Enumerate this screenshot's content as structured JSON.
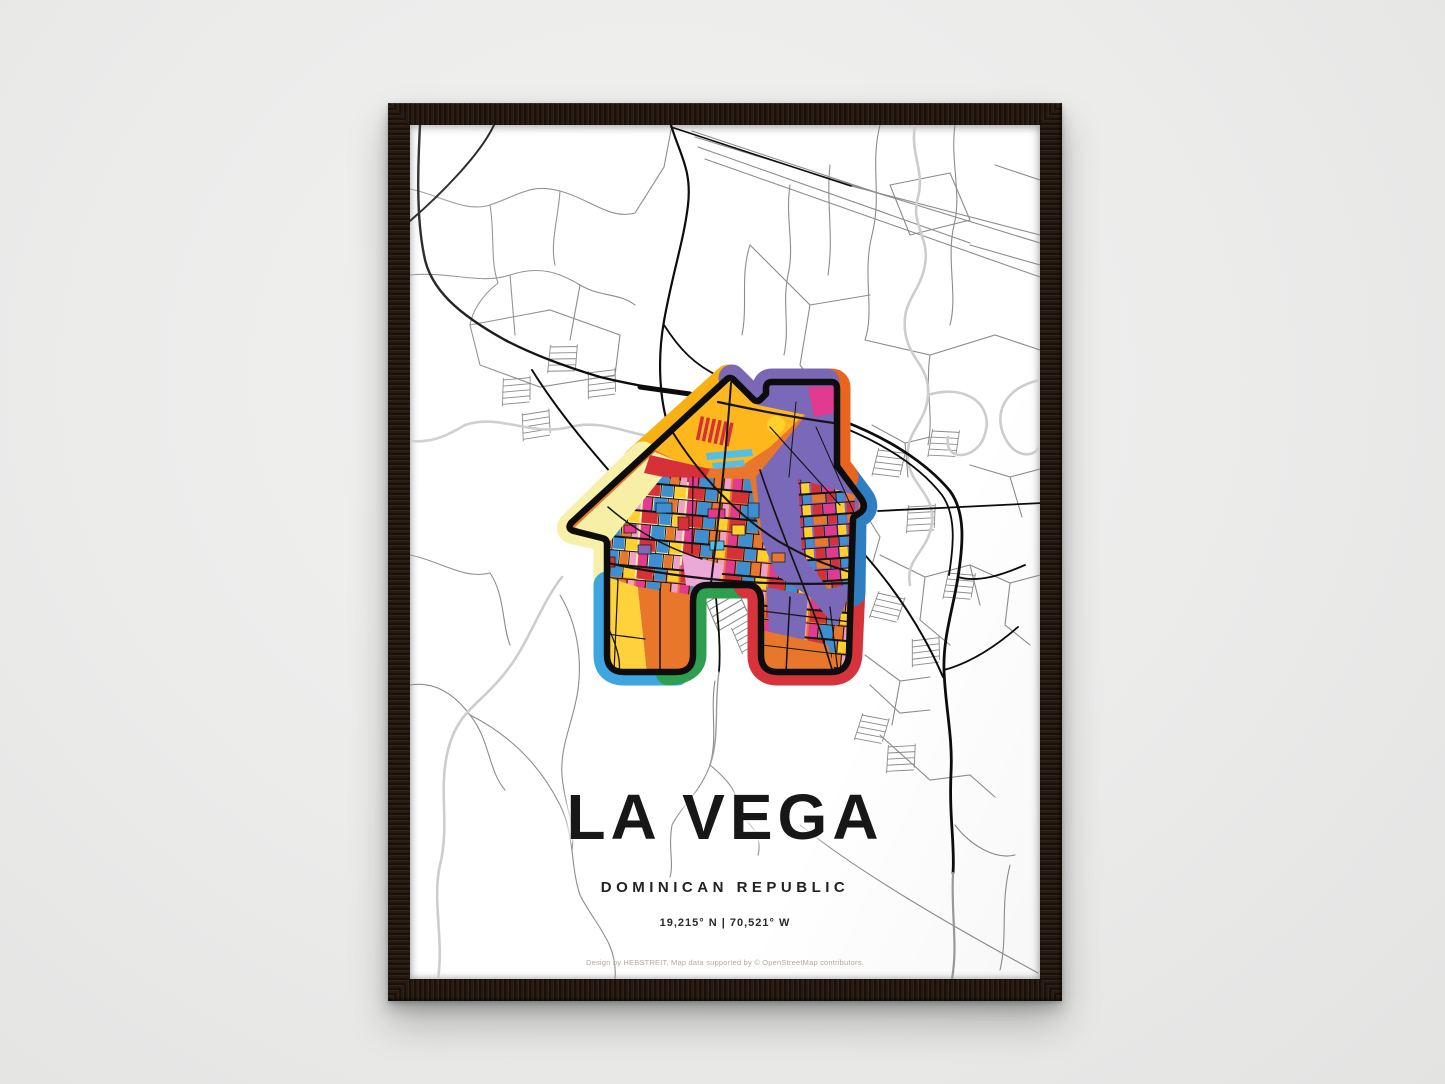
{
  "scene": {
    "wall_color": "#ebebea",
    "frame_color": "#20160e"
  },
  "poster": {
    "title": "LA VEGA",
    "subtitle": "DOMINICAN REPUBLIC",
    "coordinates": "19,215° N | 70,521° W",
    "credit": "Design by HEBSTREIT, Map data supported by © OpenStreetMap contributors.",
    "map": {
      "motif": "house-shaped-colorful-city-map",
      "palette": [
        "#F9B013",
        "#F8F0A8",
        "#7B68B5",
        "#E8641F",
        "#2F7EC2",
        "#D7333B",
        "#2E9E4F",
        "#3FA5DE",
        "#E8772B",
        "#E23A8E",
        "#3D8FD1",
        "#FFD02B",
        "#ECA8D6",
        "#55BEE8"
      ]
    }
  }
}
